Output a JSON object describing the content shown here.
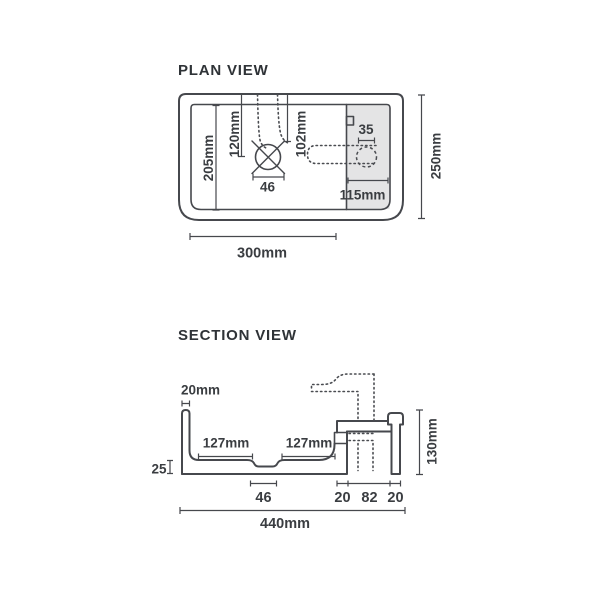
{
  "page": {
    "background": "#ffffff"
  },
  "colors": {
    "line": "#46484d",
    "text": "#3a3d41",
    "panel_fill": "#e4e4e5"
  },
  "plan": {
    "title": "PLAN VIEW",
    "dims": {
      "basin_length": "205mm",
      "drain_offset_y": "120mm",
      "drain_offset_x": "102mm",
      "drain_width": "46",
      "tap_hole": "35",
      "deck_width": "115mm",
      "overall_width": "300mm",
      "overall_depth": "250mm"
    }
  },
  "section": {
    "title": "SECTION VIEW",
    "dims": {
      "wall_thickness": "20mm",
      "bowl_left": "127mm",
      "bowl_right": "127mm",
      "base_thickness": "25",
      "drain_width": "46",
      "ledge_left": "20",
      "recess_width": "82",
      "wall_right": "20",
      "overall_width": "440mm",
      "overall_height": "130mm"
    }
  }
}
